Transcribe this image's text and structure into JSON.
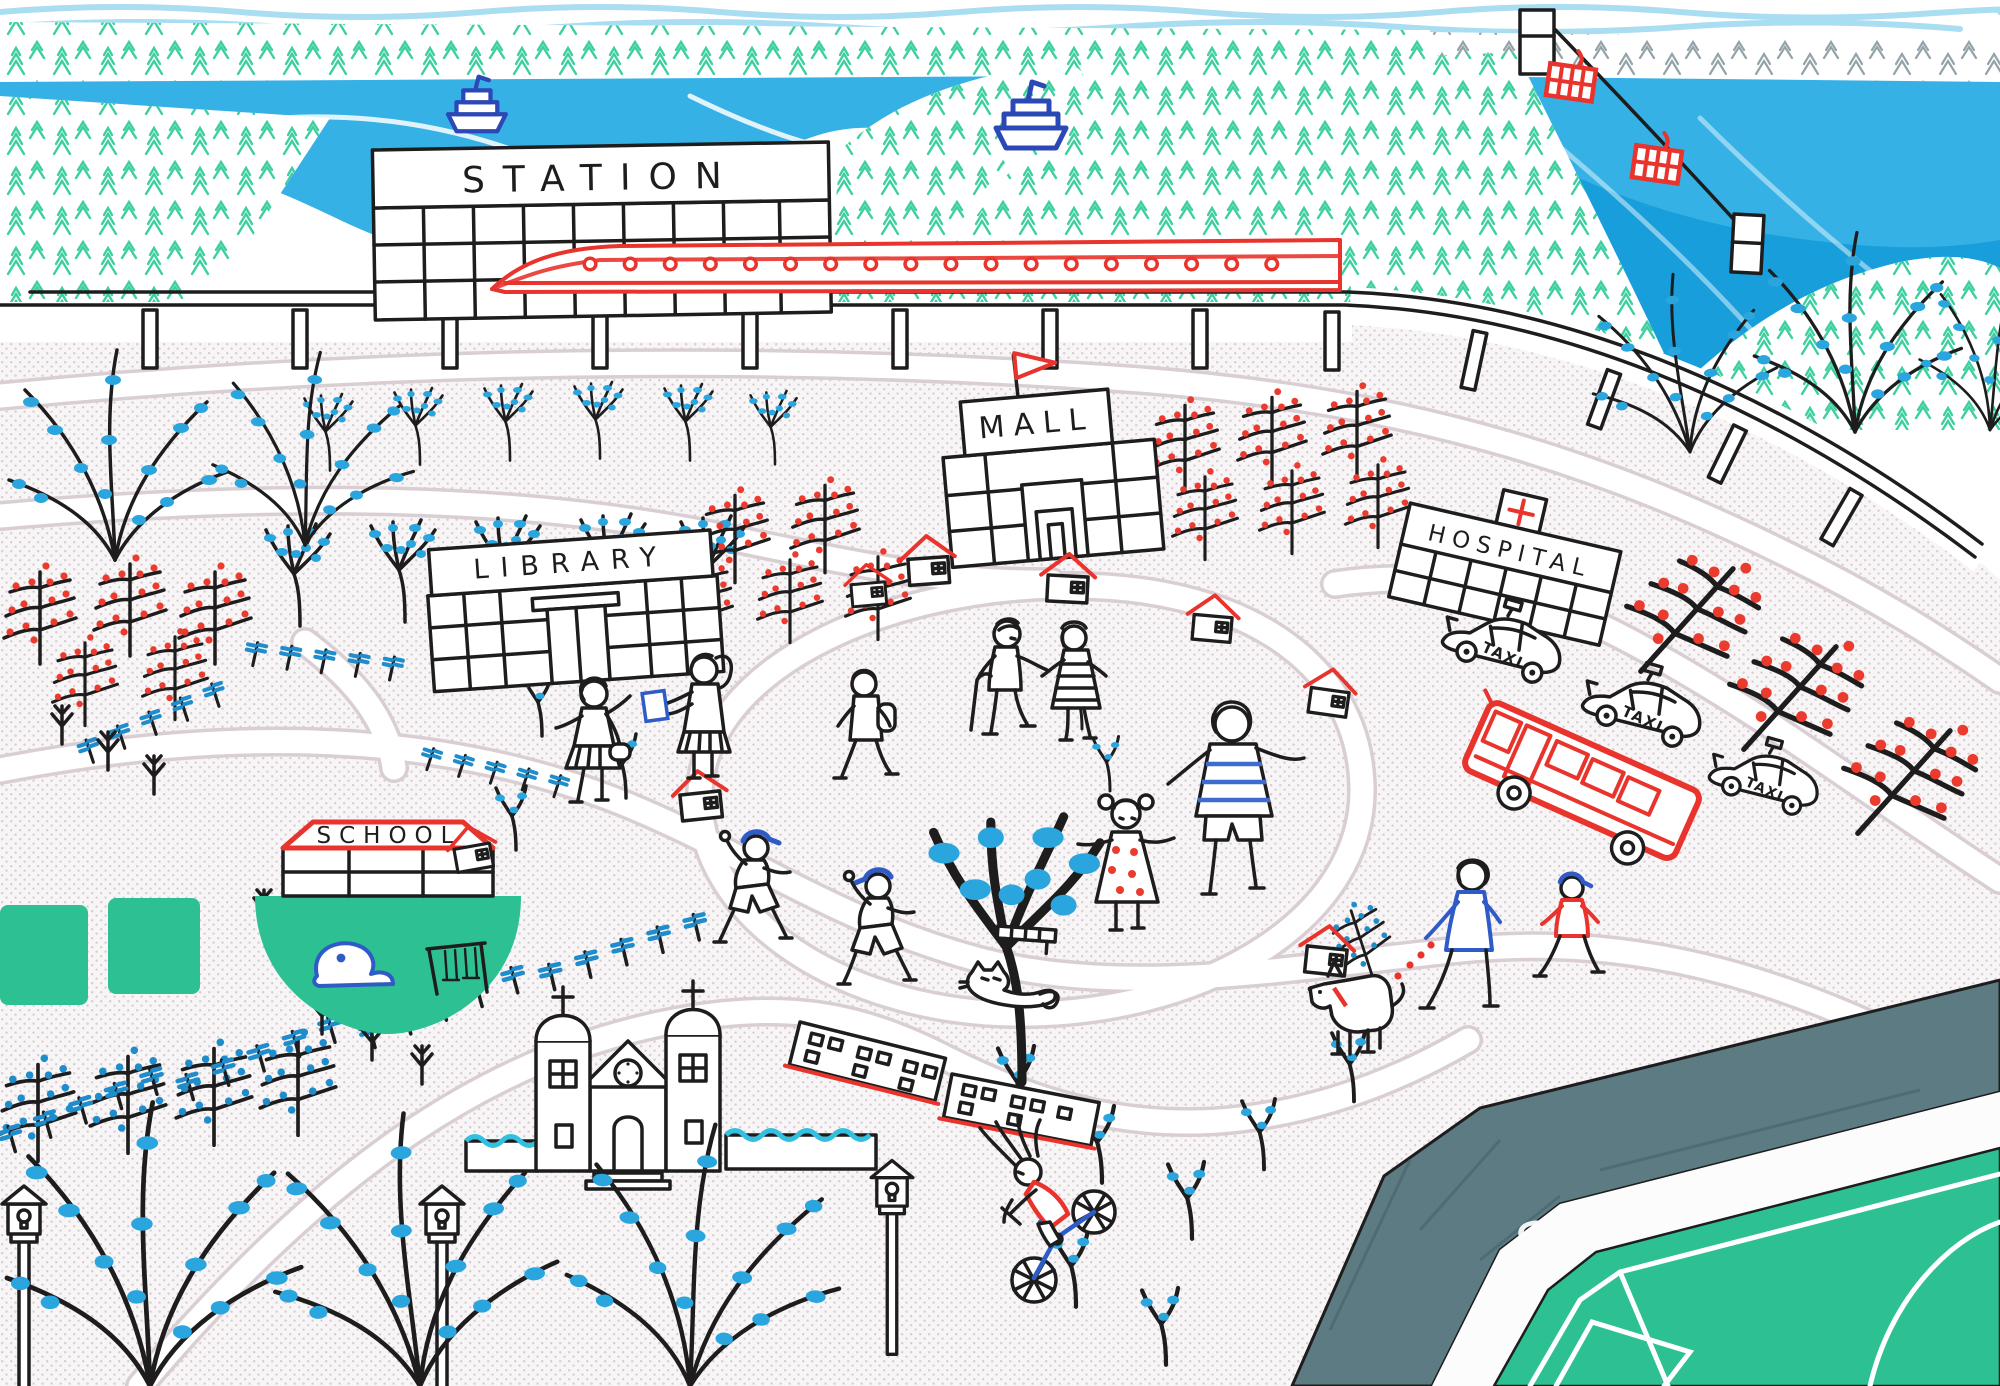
{
  "scene": {
    "title": "Hand-drawn illustrated town map",
    "landmarks": {
      "station": {
        "label": "STATION"
      },
      "mall": {
        "label": "MALL"
      },
      "library": {
        "label": "LIBRARY"
      },
      "hospital": {
        "label": "HOSPITAL"
      },
      "school": {
        "label": "SCHOOL"
      },
      "stadium": {
        "label": "STADIUM"
      },
      "church": {
        "description": "church with twin domed towers, crosses and clock"
      }
    },
    "vehicles": {
      "taxi": {
        "label": "TAXI",
        "count": 3
      },
      "bus": {
        "description": "red city bus"
      },
      "train": {
        "description": "red high-speed train with round windows at the station platform"
      },
      "boats": {
        "count": 2,
        "description": "blue outlined ships on the bay"
      },
      "cable_car": {
        "gondolas": 2,
        "description": "red gondolas on a cable crossing the bay"
      }
    },
    "people": [
      "girl with shoulder bag",
      "girl holding a blue book",
      "boy with backpack",
      "elderly man with cane",
      "elderly woman in striped dress",
      "woman in blue striped shirt",
      "girl in red polka-dot dress",
      "two boys in blue caps",
      "person walking a dog",
      "boy in red shirt and blue cap",
      "cyclist in red shirt on blue bicycle"
    ],
    "animals": [
      "cat",
      "white dog on red dotted leash"
    ],
    "nature": [
      "pine forest hills",
      "bay water with waves",
      "orchard trees with blue leaves",
      "espalier trees with red berries",
      "espalier trees with blue berries",
      "hedge fences with blue tufts",
      "large bare trees with blue buds",
      "green school playground",
      "green stadium pitch"
    ],
    "colors": {
      "water": "#35b1e6",
      "water_deep": "#179edb",
      "sky_wave": "#a9ddf2",
      "pine": "#3ecfa0",
      "ink": "#1e1d1e",
      "red": "#e8342c",
      "leaf_blue": "#2aa5dd",
      "hedge_blue": "#1f8ccb",
      "boat_blue": "#2b48b6",
      "cap_blue": "#2f5bc6",
      "green": "#2cc092",
      "stadium_stand": "#5d7b82",
      "stipple": "#cdbfc7"
    }
  }
}
